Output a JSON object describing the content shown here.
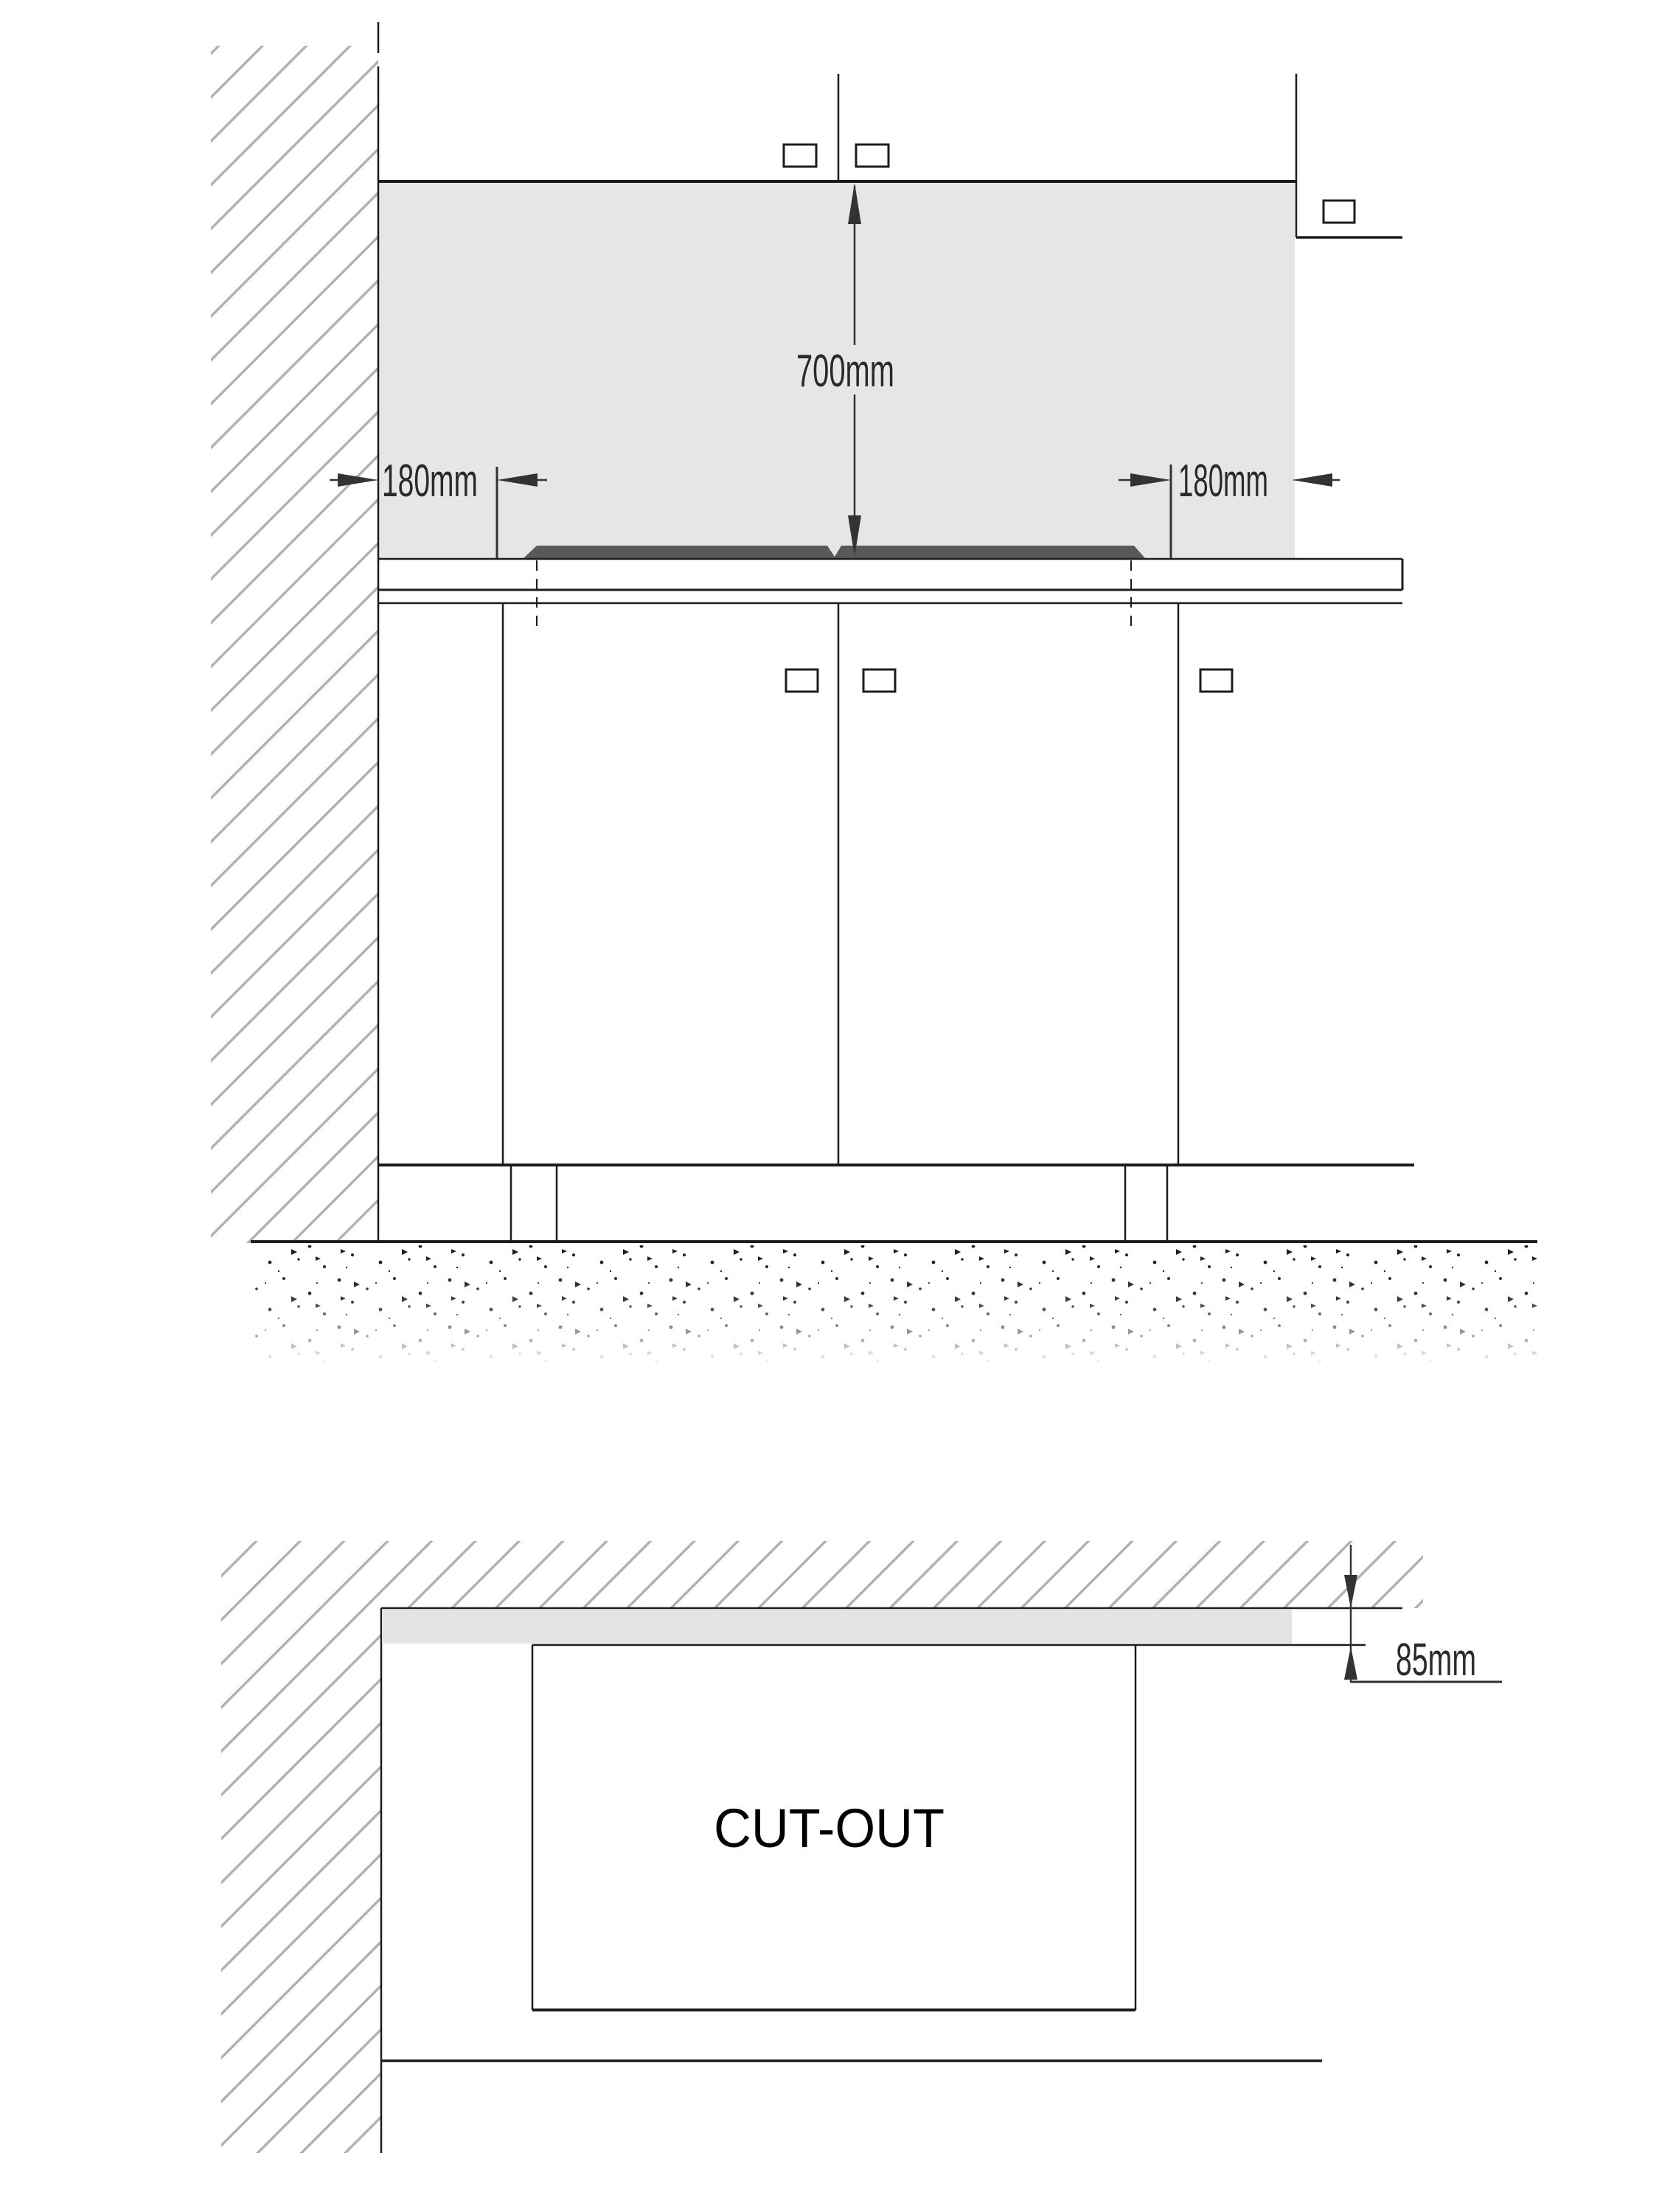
{
  "labels": {
    "clearance_height": "700mm",
    "clearance_left": "180mm",
    "clearance_right": "180mm",
    "wall_distance": "85mm",
    "cutout": "CUT-OUT"
  },
  "colors": {
    "clearance_zone": "#e6e6e6",
    "counter_strip": "#e3e3e3",
    "hob": "#595959",
    "hatch": "#b0b0b0",
    "line": "#1c1c1c",
    "dots": "#1a1a1a"
  }
}
